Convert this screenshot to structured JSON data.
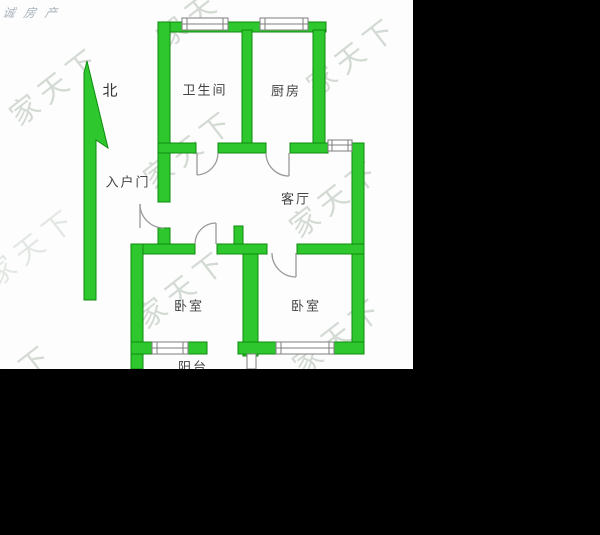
{
  "agency": {
    "text": "诚房产"
  },
  "watermark": {
    "text": "家天下"
  },
  "compass": {
    "label": "北"
  },
  "rooms": {
    "bathroom": "卫生间",
    "kitchen": "厨房",
    "entry": "入户门",
    "living": "客厅",
    "bedroom_left": "卧室",
    "bedroom_right": "卧室",
    "balcony": "阳台"
  },
  "colors": {
    "wall_green": "#2ec82e",
    "wall_outline": "#0d8a0d",
    "door_line": "#9a9a9a",
    "window_line": "#7d7d7d",
    "watermark": "#aab8aa",
    "label_text": "#444444",
    "agency_text": "#a9b3bd",
    "background": "#ffffff",
    "letterbox": "#000000"
  }
}
